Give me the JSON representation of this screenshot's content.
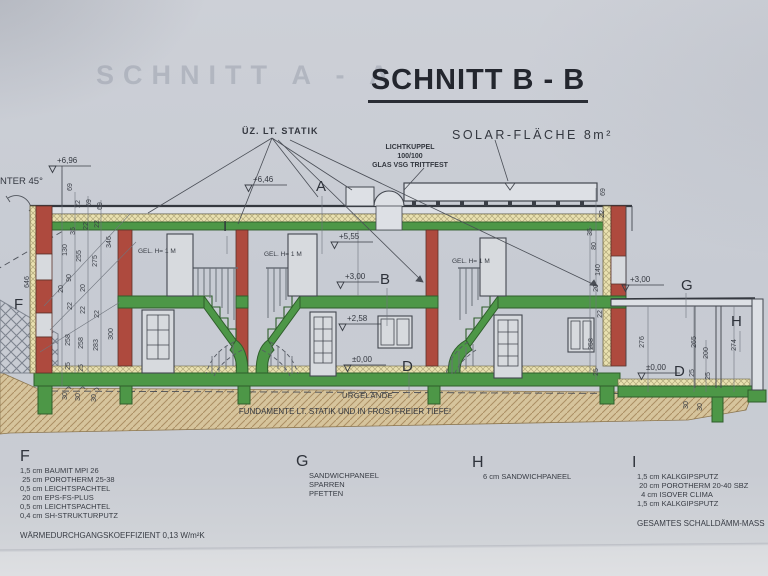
{
  "title": "SCHNITT B - B",
  "watermark": "SCHNITT A - A",
  "annotations": {
    "uez_statik": "ÜZ. LT. STATIK",
    "solar": "SOLAR-FLÄCHE 8m²",
    "lichtkuppel_1": "LICHTKUPPEL",
    "lichtkuppel_2": "100/100",
    "lichtkuppel_3": "GLAS VSG TRITTFEST",
    "unter45": "NTER 45°",
    "urgelaende": "URGELÄNDE",
    "fundamente": "FUNDAMENTE LT. STATIK UND IN FROSTFREIER TIEFE!"
  },
  "gel_labels": [
    {
      "t": "GEL. H= 1 M",
      "x": 138,
      "y": 253
    },
    {
      "t": "GEL. H= 1 M",
      "x": 264,
      "y": 256
    },
    {
      "t": "GEL. H= 1 M",
      "x": 452,
      "y": 263
    }
  ],
  "section_marks": [
    {
      "l": "A",
      "x": 316,
      "y": 191
    },
    {
      "l": "B",
      "x": 380,
      "y": 284
    },
    {
      "l": "D",
      "x": 402,
      "y": 371
    },
    {
      "l": "D",
      "x": 674,
      "y": 376
    },
    {
      "l": "F",
      "x": 14,
      "y": 309
    },
    {
      "l": "G",
      "x": 681,
      "y": 290
    },
    {
      "l": "H",
      "x": 731,
      "y": 326
    },
    {
      "l": "I",
      "x": 223,
      "y": 231
    }
  ],
  "elevations": [
    {
      "v": "+6,96",
      "x": 57,
      "y": 163
    },
    {
      "v": "+6,46",
      "x": 253,
      "y": 182
    },
    {
      "v": "+5,55",
      "x": 339,
      "y": 239
    },
    {
      "v": "+3,00",
      "x": 345,
      "y": 279
    },
    {
      "v": "+2,58",
      "x": 347,
      "y": 321
    },
    {
      "v": "±0,00",
      "x": 352,
      "y": 362
    },
    {
      "v": "+3,00",
      "x": 630,
      "y": 282
    },
    {
      "v": "±0,00",
      "x": 646,
      "y": 370
    }
  ],
  "dims": [
    {
      "v": "69",
      "x": 72,
      "y": 187
    },
    {
      "v": "22",
      "x": 80,
      "y": 204
    },
    {
      "v": "69",
      "x": 91,
      "y": 203
    },
    {
      "v": "69",
      "x": 102,
      "y": 206
    },
    {
      "v": "35",
      "x": 75,
      "y": 231
    },
    {
      "v": "22",
      "x": 88,
      "y": 226
    },
    {
      "v": "22",
      "x": 99,
      "y": 224
    },
    {
      "v": "130",
      "x": 67,
      "y": 250
    },
    {
      "v": "255",
      "x": 81,
      "y": 256
    },
    {
      "v": "275",
      "x": 97,
      "y": 261
    },
    {
      "v": "346",
      "x": 111,
      "y": 242
    },
    {
      "v": "90",
      "x": 71,
      "y": 278
    },
    {
      "v": "20",
      "x": 63,
      "y": 289
    },
    {
      "v": "20",
      "x": 85,
      "y": 288
    },
    {
      "v": "646",
      "x": 29,
      "y": 282
    },
    {
      "v": "22",
      "x": 72,
      "y": 306
    },
    {
      "v": "22",
      "x": 85,
      "y": 310
    },
    {
      "v": "22",
      "x": 99,
      "y": 314
    },
    {
      "v": "258",
      "x": 70,
      "y": 340
    },
    {
      "v": "258",
      "x": 83,
      "y": 343
    },
    {
      "v": "283",
      "x": 98,
      "y": 345
    },
    {
      "v": "300",
      "x": 113,
      "y": 334
    },
    {
      "v": "25",
      "x": 70,
      "y": 366
    },
    {
      "v": "25",
      "x": 83,
      "y": 368
    },
    {
      "v": "30",
      "x": 67,
      "y": 396
    },
    {
      "v": "30",
      "x": 80,
      "y": 397
    },
    {
      "v": "30",
      "x": 96,
      "y": 398
    },
    {
      "v": "69",
      "x": 605,
      "y": 192
    },
    {
      "v": "22",
      "x": 604,
      "y": 214
    },
    {
      "v": "35",
      "x": 592,
      "y": 232
    },
    {
      "v": "80",
      "x": 596,
      "y": 246
    },
    {
      "v": "140",
      "x": 600,
      "y": 270
    },
    {
      "v": "20",
      "x": 598,
      "y": 288
    },
    {
      "v": "22",
      "x": 602,
      "y": 314
    },
    {
      "v": "258",
      "x": 593,
      "y": 344
    },
    {
      "v": "25",
      "x": 598,
      "y": 372
    },
    {
      "v": "276",
      "x": 644,
      "y": 342
    },
    {
      "v": "265",
      "x": 696,
      "y": 342
    },
    {
      "v": "200",
      "x": 708,
      "y": 353
    },
    {
      "v": "274",
      "x": 736,
      "y": 345
    },
    {
      "v": "25",
      "x": 694,
      "y": 373
    },
    {
      "v": "25",
      "x": 710,
      "y": 376
    },
    {
      "v": "30",
      "x": 688,
      "y": 405
    },
    {
      "v": "30",
      "x": 702,
      "y": 407
    }
  ],
  "legend": {
    "f": {
      "letter": "F",
      "items": [
        "1,5 cm BAUMIT MPI 26",
        " 25 cm POROTHERM 25-38",
        "0,5 cm LEICHTSPACHTEL",
        " 20 cm EPS-FS-PLUS",
        "0,5 cm LEICHTSPACHTEL",
        "0,4 cm SH-STRUKTURPUTZ"
      ],
      "note": "WÄRMEDURCHGANGSKOEFFIZIENT 0,13 W/m²K"
    },
    "g": {
      "letter": "G",
      "items": [
        "SANDWICHPANEEL",
        "SPARREN",
        "PFETTEN"
      ],
      "note": ""
    },
    "h": {
      "letter": "H",
      "items": [
        "6 cm SANDWICHPANEEL"
      ],
      "note": ""
    },
    "i": {
      "letter": "I",
      "items": [
        "1,5 cm KALKGIPSPUTZ",
        " 20 cm POROTHERM 20-40 SBZ",
        "  4 cm ISOVER CLIMA",
        "1,5 cm KALKGIPSPUTZ"
      ],
      "note": "GESAMTES SCHALLDÄMM-MASS   5"
    }
  },
  "colors": {
    "paper": "#c8ccd4",
    "wall_red": "#ae4a3e",
    "floor_green": "#4d9747",
    "insulation_yellow": "#e9e1b0",
    "ground_tan": "#d6c49c",
    "line": "#3a3e46"
  }
}
